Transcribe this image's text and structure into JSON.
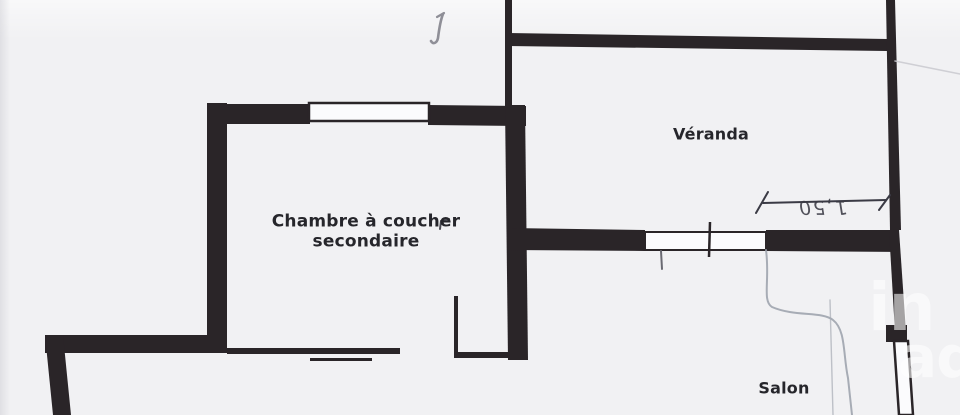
{
  "rooms": [
    {
      "name": "chambre-secondaire",
      "label_line1": "Chambre à coucher",
      "label_line2": "secondaire"
    },
    {
      "name": "veranda",
      "label": "Véranda"
    },
    {
      "name": "salon",
      "label": "Salon"
    }
  ],
  "handwritten": {
    "dimension": "1,50"
  },
  "watermark": {
    "brand": "iad",
    "top_fragment": "in",
    "bottom_fragment": "ad"
  },
  "colors": {
    "paper": "#f1f1f3",
    "wall_ink": "#2a2528",
    "window_fill": "#fbfbfd",
    "pencil": "#9aa0aa",
    "label_ink": "#26262b",
    "watermark": "rgba(255,255,255,0.58)"
  }
}
